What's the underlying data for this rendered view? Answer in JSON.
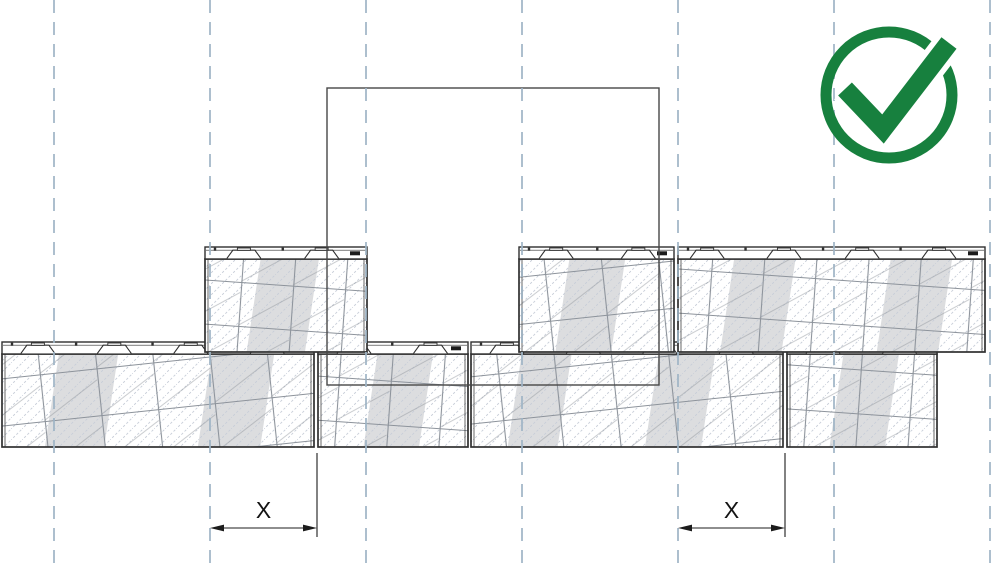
{
  "page": {
    "type": "technical-installation-diagram",
    "subject": "wall-block courses with staggered vertical joints (correct method)"
  },
  "canvas": {
    "width": 992,
    "height": 565,
    "background": "#ffffff"
  },
  "colors": {
    "grid_line": "#9fb5c6",
    "block_outline": "#2f2f2f",
    "hatch_line": "#c7cdd8",
    "stone_line": "#8d939b",
    "shade_band": "#dcdddf",
    "square_outline": "#474747",
    "dimension_line": "#1c1c1c",
    "check_green": "#17803e",
    "block_fill": "#ffffff"
  },
  "grid": {
    "lines_x": [
      54,
      210,
      366,
      522,
      678,
      834,
      990
    ],
    "dash": [
      13,
      9
    ],
    "stroke_width": 2
  },
  "reference_square": {
    "x": 327,
    "y": 88,
    "width": 332,
    "height": 297
  },
  "courses": [
    {
      "name": "upper-course",
      "y": 247,
      "height": 105,
      "cap_height": 12,
      "blocks": [
        {
          "x": 205,
          "width": 162,
          "notch_fracs": [
            0.24,
            0.72
          ],
          "bands": [
            [
              0.3,
              0.66
            ]
          ],
          "texture": "a"
        },
        {
          "x": 519,
          "width": 155,
          "notch_fracs": [
            0.24,
            0.77
          ],
          "bands": [
            [
              0.28,
              0.64
            ]
          ],
          "texture": "b"
        },
        {
          "x": 678,
          "width": 307,
          "notch_fracs": [
            0.095,
            0.345,
            0.6,
            0.85
          ],
          "bands": [
            [
              0.16,
              0.36
            ],
            [
              0.67,
              0.87
            ]
          ],
          "texture": "a"
        }
      ]
    },
    {
      "name": "lower-course",
      "y": 342,
      "height": 105,
      "cap_height": 12,
      "blocks": [
        {
          "x": 2,
          "width": 312,
          "notch_fracs": [
            0.115,
            0.36,
            0.605,
            0.85
          ],
          "bands": [
            [
              0.16,
              0.35
            ],
            [
              0.65,
              0.85
            ]
          ],
          "texture": "b"
        },
        {
          "x": 318,
          "width": 150,
          "notch_fracs": [
            0.24,
            0.75
          ],
          "bands": [
            [
              0.35,
              0.72
            ]
          ],
          "texture": "a"
        },
        {
          "x": 471,
          "width": 312,
          "notch_fracs": [
            0.115,
            0.36,
            0.605,
            0.85
          ],
          "bands": [
            [
              0.14,
              0.3
            ],
            [
              0.58,
              0.76
            ]
          ],
          "texture": "b"
        },
        {
          "x": 787,
          "width": 150,
          "notch_fracs": [
            0.24,
            0.75
          ],
          "bands": [
            [
              0.33,
              0.7
            ]
          ],
          "texture": "a"
        }
      ]
    }
  ],
  "dimensions": [
    {
      "label": "X",
      "from_x": 210,
      "to_x": 317,
      "arrow_y": 528,
      "label_y": 518,
      "extension_line": {
        "x": 317,
        "y1": 453,
        "y2": 537
      }
    },
    {
      "label": "X",
      "from_x": 678,
      "to_x": 785,
      "arrow_y": 528,
      "label_y": 518,
      "extension_line": {
        "x": 785,
        "y1": 453,
        "y2": 537
      }
    }
  ],
  "status_icon": {
    "name": "check-circle-icon",
    "x": 818,
    "y": 22,
    "color": "#17803e"
  }
}
